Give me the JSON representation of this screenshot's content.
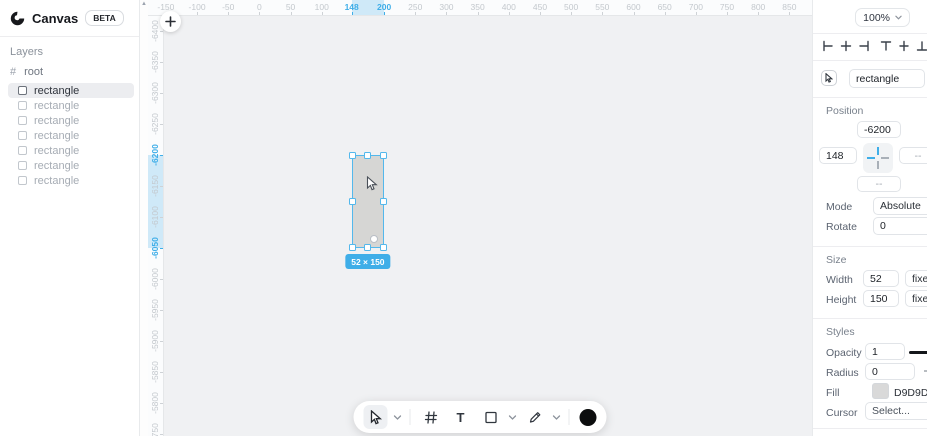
{
  "app": {
    "brand": "Canvas",
    "beta": "BETA"
  },
  "colors": {
    "accent": "#3FAEE8",
    "selection_band": "#CFE9F8",
    "canvas_bg": "#F0F1F3",
    "rect_fill": "#D9D9D9"
  },
  "sidebar": {
    "layers_title": "Layers",
    "root_label": "root",
    "layers": [
      {
        "label": "rectangle",
        "selected": true
      },
      {
        "label": "rectangle",
        "selected": false
      },
      {
        "label": "rectangle",
        "selected": false
      },
      {
        "label": "rectangle",
        "selected": false
      },
      {
        "label": "rectangle",
        "selected": false
      },
      {
        "label": "rectangle",
        "selected": false
      },
      {
        "label": "rectangle",
        "selected": false
      }
    ]
  },
  "rulers": {
    "horizontal": {
      "values": [
        -150,
        -100,
        -50,
        0,
        50,
        100,
        148,
        200,
        250,
        300,
        350,
        400,
        450,
        500,
        550,
        600,
        650,
        700,
        750,
        800,
        850
      ],
      "active": [
        148,
        200
      ],
      "selection": {
        "from": 148,
        "to": 200
      }
    },
    "vertical": {
      "values": [
        -6400,
        -6350,
        -6300,
        -6250,
        -6200,
        -6150,
        -6100,
        -6050,
        -6000,
        -5950,
        -5900,
        -5850,
        -5800,
        -5750
      ],
      "active": [
        -6200,
        -6050
      ],
      "selection": {
        "from": -6200,
        "to": -6050
      }
    }
  },
  "canvas": {
    "rect": {
      "x": 148,
      "y": -6200,
      "w": 52,
      "h": 150
    },
    "size_badge": "52 × 150"
  },
  "toolbar": {
    "text_tool_glyph": "T"
  },
  "inspector": {
    "zoom": "100%",
    "name_field": "rectangle",
    "position": {
      "title": "Position",
      "x": "148",
      "y": "-6200",
      "right": "--",
      "bottom": "--",
      "mode_label": "Mode",
      "mode_value": "Absolute",
      "rotate_label": "Rotate",
      "rotate_value": "0"
    },
    "size": {
      "title": "Size",
      "width_label": "Width",
      "width_value": "52",
      "width_mode": "fixed",
      "height_label": "Height",
      "height_value": "150",
      "height_mode": "fixed"
    },
    "styles": {
      "title": "Styles",
      "opacity_label": "Opacity",
      "opacity_value": "1",
      "radius_label": "Radius",
      "radius_value": "0",
      "fill_label": "Fill",
      "fill_value": "D9D9D9",
      "cursor_label": "Cursor",
      "cursor_value": "Select..."
    }
  }
}
